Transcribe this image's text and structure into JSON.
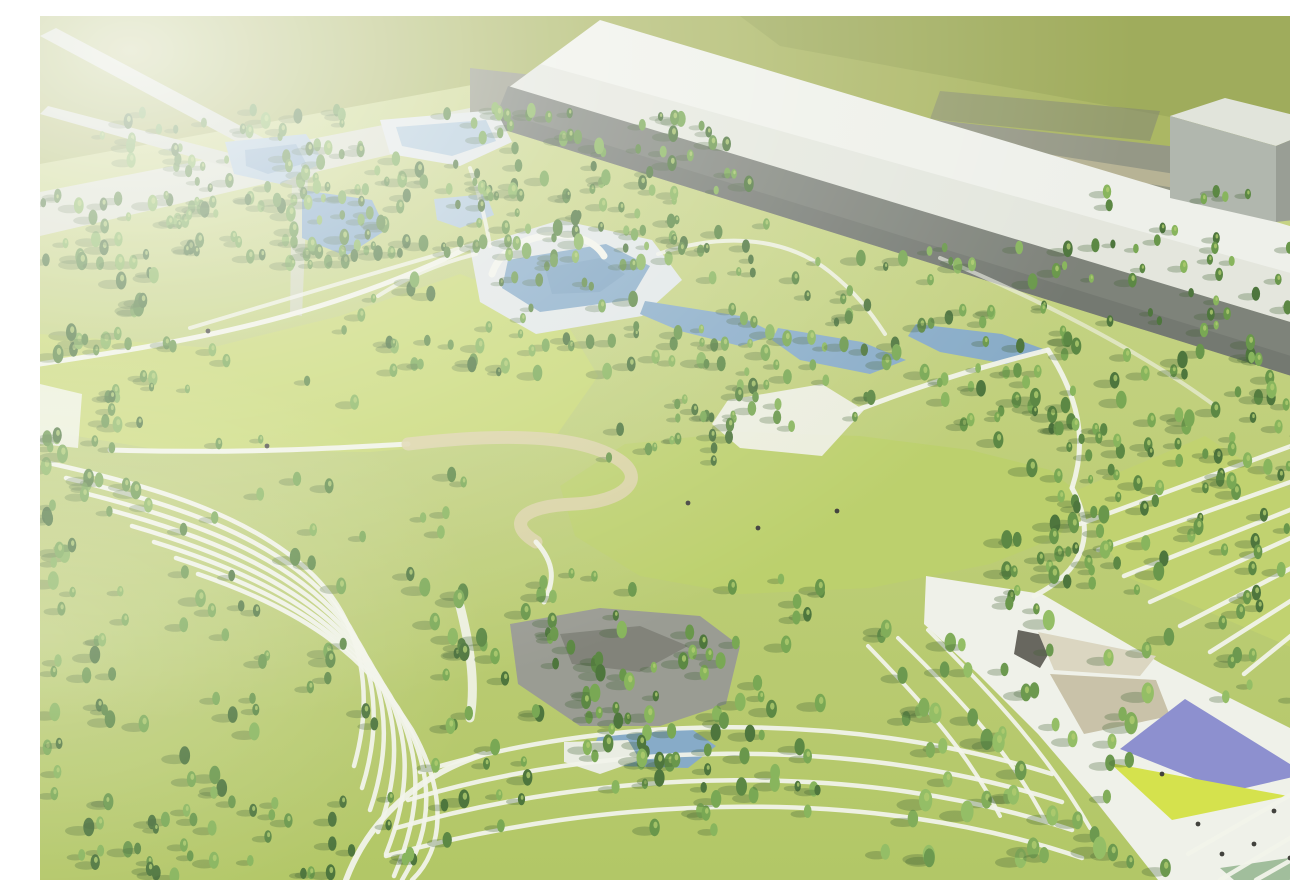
{
  "meta": {
    "description": "Hazy aerial architectural rendering of a large landscaped park: dense conifer forest, central great lawn, aquatic pool terraces with white arch, ponds, a rocky water garden, sweeping terraced lawn paths, an angular event plaza with purple and chartreuse canopies, and long gray industrial buildings along the top edge"
  },
  "colors": {
    "base_top": "#c8d484",
    "base_bottom": "#abc258",
    "field": "#a3b055",
    "field_dark": "#909f48",
    "road": "#8b8e7b",
    "road_dark": "#74776a",
    "tanline": "#cfc49a",
    "roof": "#eef0ea",
    "roof_shade": "#d2d6cc",
    "wall": "#71766e",
    "wall_dark": "#5f645d",
    "bldg_top": "#dfe2da",
    "bldg_left": "#aab0a7",
    "bldg_front": "#8f958c",
    "boundary": "#d7dcc9",
    "ramp": "#cfd5c3",
    "meadow": "#c3d567",
    "lawn": "#b6cc5f",
    "slope_lawn": "#bccf63",
    "path": "#f1f3ea",
    "tan": "#d9cfa2",
    "deck": "#dfe5e6",
    "water": "#7ba3c4",
    "water_light": "#a9c4d8",
    "water_deep": "#6792b6",
    "rock": "#90928a",
    "rock_dark": "#6e7067",
    "sand": "#e9ece3",
    "plaza": "#eff1e9",
    "canopy_dark": "#595750",
    "canopy_light": "#d8d3bd",
    "canopy_tan": "#c4bda2",
    "purple": "#8285cc",
    "chartreuse": "#d2e03c",
    "teal_lawn": "#98b893",
    "dot": "#2e2e2a",
    "tree_shadow": "#2f5220",
    "tree_fleck": "#a9c862",
    "haze": "#f2f5e8",
    "tree_palette": [
      "#3c682a",
      "#4b7c31",
      "#5a8d39",
      "#6ba043",
      "#7cae4d"
    ],
    "tree_light": [
      "#5d8f3e",
      "#74a54a",
      "#8ab857"
    ]
  },
  "scene": {
    "width": 1290,
    "height": 864,
    "polygons": [
      {
        "name": "far-field",
        "points": "0,0 1290,0 1290,170 470,62 0,148",
        "fill": "field"
      },
      {
        "name": "far-field-dark",
        "points": "700,0 1290,0 1290,130 740,30",
        "fill": "field_dark",
        "opacity": 0.7
      },
      {
        "name": "perimeter-road",
        "points": "430,52 1290,148 1290,208 430,102",
        "fill": "road"
      },
      {
        "name": "road-patch",
        "points": "900,75 1120,95 1110,125 890,103",
        "fill": "road_dark",
        "opacity": 0.5
      },
      {
        "name": "road-verge-strip",
        "points": "620,78 1290,182 1290,196 620,92",
        "fill": "tanline",
        "opacity": 0.55
      },
      {
        "name": "warehouse-roof",
        "points": "560,4 1290,222 1290,318 468,72",
        "fill": "roof"
      },
      {
        "name": "warehouse-roof-shade",
        "points": "500,48 1290,268 1290,318 468,72",
        "fill": "roof_shade",
        "opacity": 0.45
      },
      {
        "name": "warehouse-wall",
        "points": "468,70 1290,318 1290,372 452,110",
        "fill": "wall"
      },
      {
        "name": "warehouse-wall-base",
        "points": "460,96 1290,352 1290,372 452,110",
        "fill": "wall_dark",
        "opacity": 0.6
      },
      {
        "name": "annex-building-top",
        "points": "1130,100 1185,82 1290,108 1236,130",
        "fill": "bldg_top"
      },
      {
        "name": "annex-building-left",
        "points": "1130,100 1236,130 1236,206 1130,182",
        "fill": "bldg_left"
      },
      {
        "name": "annex-building-front",
        "points": "1236,130 1290,108 1290,200 1236,206",
        "fill": "bldg_front"
      },
      {
        "name": "boundary-wall",
        "points": "0,176 430,92 430,120 0,220",
        "fill": "boundary"
      },
      {
        "name": "overpass-ramp-a",
        "points": "0,20 16,12 280,152 268,164",
        "fill": "ramp"
      },
      {
        "name": "overpass-ramp-b",
        "points": "0,98 8,90 270,158 262,172",
        "fill": "ramp"
      },
      {
        "name": "overpass-pier",
        "points": "252,162 268,160 262,300 250,298",
        "fill": "ramp",
        "opacity": 0.8
      },
      {
        "name": "west-meadow",
        "points": "0,318 170,332 300,300 420,258 520,296 558,360 516,420 330,436 120,434 0,414",
        "fill": "meadow"
      },
      {
        "name": "west-entry-pad",
        "points": "0,368 42,378 38,432 0,428",
        "fill": "path",
        "opacity": 0.85
      },
      {
        "name": "great-lawn",
        "points": "520,470 585,428 700,416 820,420 930,434 1010,454 1040,478 1020,520 950,548 830,572 700,578 600,560 535,520",
        "fill": "lawn"
      },
      {
        "name": "east-slope-lawn",
        "points": "1035,475 1165,420 1290,500 1290,648 1085,560",
        "fill": "slope_lawn"
      },
      {
        "name": "pool-deck",
        "points": "430,232 520,204 612,224 642,264 602,300 496,318 440,286",
        "fill": "deck"
      },
      {
        "name": "main-pool",
        "points": "468,244 566,228 610,250 590,284 500,296 462,272",
        "fill": "water"
      },
      {
        "name": "main-pool-deep",
        "points": "505,252 560,242 585,258 560,276 512,278",
        "fill": "water_deep",
        "opacity": 0.6
      },
      {
        "name": "cascade-pool-1",
        "points": "605,285 700,300 736,318 700,330 640,315 600,298",
        "fill": "water"
      },
      {
        "name": "cascade-pool-2",
        "points": "738,312 822,326 866,344 830,358 760,344 732,324",
        "fill": "water"
      },
      {
        "name": "cascade-pool-3",
        "points": "876,308 962,318 1006,334 966,348 900,336 868,320",
        "fill": "water"
      },
      {
        "name": "central-court",
        "points": "688,384 782,368 824,394 782,440 700,432 672,408",
        "fill": "plaza",
        "opacity": 0.9
      },
      {
        "name": "north-pond-deck",
        "points": "185,126 266,118 284,146 240,168 194,158",
        "fill": "water_light"
      },
      {
        "name": "north-pond",
        "points": "205,134 256,128 266,147 228,158 206,150",
        "fill": "water",
        "opacity": 0.8
      },
      {
        "name": "terrace-pond-rim",
        "points": "340,104 456,94 472,126 420,150 350,138",
        "fill": "deck"
      },
      {
        "name": "terrace-pond",
        "points": "356,111 446,104 456,125 412,140 362,130",
        "fill": "water_light"
      },
      {
        "name": "forest-pond",
        "points": "262,174 332,184 346,214 306,240 262,222",
        "fill": "water"
      },
      {
        "name": "small-pond",
        "points": "394,183 446,178 454,199 420,212 397,204",
        "fill": "water_light"
      },
      {
        "name": "rock-garden",
        "points": "470,608 560,592 660,600 700,630 686,688 620,710 540,710 478,668",
        "fill": "rock"
      },
      {
        "name": "rock-garden-dark",
        "points": "520,618 600,610 648,630 600,656 532,648",
        "fill": "rock_dark",
        "opacity": 0.8
      },
      {
        "name": "rock-pond",
        "points": "560,716 650,712 676,730 648,752 580,750 552,734",
        "fill": "water"
      },
      {
        "name": "rock-sand",
        "points": "524,726 588,724 600,744 560,758 524,746",
        "fill": "sand"
      },
      {
        "name": "event-plaza",
        "points": "886,560 1002,578 1122,648 1290,732 1290,864 1118,864 1058,788 998,718 938,658 884,608",
        "fill": "plaza"
      },
      {
        "name": "plaza-canopy-dark",
        "points": "978,614 1018,622 1000,652 974,638",
        "fill": "canopy_dark"
      },
      {
        "name": "plaza-canopy-light",
        "points": "998,616 1116,640 1100,660 1014,654",
        "fill": "canopy_light"
      },
      {
        "name": "plaza-canopy-tan",
        "points": "1010,658 1116,664 1130,700 1044,718",
        "fill": "canopy_tan"
      },
      {
        "name": "plaza-purple-canopy",
        "points": "1080,733 1145,683 1266,758 1188,776",
        "fill": "purple"
      },
      {
        "name": "plaza-chartreuse-lawn",
        "points": "1070,747 1248,780 1132,804",
        "fill": "chartreuse"
      },
      {
        "name": "plaza-teal-panel",
        "points": "1180,852 1290,836 1290,864 1194,864",
        "fill": "teal_lawn"
      }
    ],
    "paths": [
      {
        "name": "meadow-top-path",
        "d": "M0,348 C130,328 280,306 440,226",
        "w": 5
      },
      {
        "name": "forest-diagonal-path",
        "d": "M150,312 C250,282 350,252 442,226",
        "w": 4,
        "opacity": 0.8
      },
      {
        "name": "meadow-bottom-path",
        "d": "M70,434 C200,438 300,432 368,428",
        "w": 5
      },
      {
        "name": "loop-promenade",
        "d": "M368,428 C470,416 540,420 576,442 C610,462 584,486 534,488 C480,490 466,508 496,526",
        "stroke": "tan",
        "w": 13,
        "opacity": 0.9
      },
      {
        "name": "loop-exit-path",
        "d": "M496,526 C516,548 514,566 504,586",
        "w": 5
      },
      {
        "name": "pool-east-path",
        "d": "M618,238 C690,214 750,224 790,256 C815,276 830,295 845,318",
        "w": 4,
        "opacity": 0.85
      },
      {
        "name": "plaza-ne-path",
        "d": "M812,396 C900,362 960,346 1008,334",
        "w": 5
      },
      {
        "name": "east-lawn-path",
        "d": "M1008,334 C1038,380 1048,424 1032,472",
        "w": 5
      },
      {
        "name": "lawn-plaza-path",
        "d": "M1032,472 C1058,520 1042,556 994,580",
        "w": 5
      },
      {
        "name": "south-entry-path",
        "d": "M306,864 C330,800 382,758 444,738",
        "w": 6
      },
      {
        "name": "rock-west-path",
        "d": "M420,590 C430,630 436,668 430,702",
        "w": 9,
        "opacity": 0.9
      },
      {
        "name": "deck-west-path",
        "d": "M436,238 C396,248 366,262 338,280",
        "w": 4,
        "opacity": 0.8
      },
      {
        "name": "pond-link-path",
        "d": "M430,152 C440,180 446,206 450,230",
        "w": 4,
        "opacity": 0.8
      },
      {
        "name": "building-base-path",
        "d": "M900,242 C1000,284 1100,334 1178,392",
        "w": 4,
        "opacity": 0.6
      },
      {
        "name": "aquatic-arch",
        "d": "M452,258 C466,214 544,206 564,240",
        "w": 7,
        "opacity": 1
      },
      {
        "name": "terrace-stripe-e1",
        "d": "M1040,508 L1262,426",
        "w": 4.5
      },
      {
        "name": "terrace-stripe-e2",
        "d": "M1058,534 L1290,452",
        "w": 4.5
      },
      {
        "name": "terrace-stripe-e3",
        "d": "M1084,560 L1290,478",
        "w": 4.5
      },
      {
        "name": "terrace-stripe-e4",
        "d": "M1110,586 L1290,504",
        "w": 4.5
      },
      {
        "name": "terrace-stripe-e5",
        "d": "M1140,610 L1290,532",
        "w": 4.5
      },
      {
        "name": "terrace-stripe-e6",
        "d": "M1170,636 L1290,560",
        "w": 4.5
      },
      {
        "name": "terrace-stripe-e7",
        "d": "M1204,658 L1290,588",
        "w": 4.5
      },
      {
        "name": "corner-stripe-1",
        "d": "M1148,838 L1290,756",
        "w": 4.5
      },
      {
        "name": "corner-stripe-2",
        "d": "M1180,864 L1290,798",
        "w": 4.5
      },
      {
        "name": "corner-stripe-3",
        "d": "M1216,864 L1290,822",
        "w": 4.5
      },
      {
        "name": "corner-stripe-4",
        "d": "M1252,864 L1290,846",
        "w": 4.5
      },
      {
        "name": "terrace-curve-w1",
        "d": "M4,446 C114,470 214,500 274,560 C324,610 334,680 314,750",
        "w": 4.5
      },
      {
        "name": "terrace-curve-w2",
        "d": "M26,462 C136,488 230,520 288,582 C336,634 344,702 322,772",
        "w": 4.5
      },
      {
        "name": "terrace-curve-w3",
        "d": "M48,478 C158,506 246,540 302,604 C348,658 354,724 330,794",
        "w": 4.5
      },
      {
        "name": "terrace-curve-w4",
        "d": "M70,494 C180,524 262,560 316,626 C360,682 364,746 338,816",
        "w": 4.5
      },
      {
        "name": "terrace-curve-w5",
        "d": "M92,510 C202,542 278,580 330,648 C372,706 374,768 346,838",
        "w": 4.5
      },
      {
        "name": "terrace-curve-w6",
        "d": "M114,526 C224,560 294,600 344,670 C384,730 384,790 354,860",
        "w": 4.5
      },
      {
        "name": "terrace-curve-w7",
        "d": "M136,542 C246,578 310,620 358,692 C396,754 394,812 362,864",
        "w": 4.5
      },
      {
        "name": "terrace-curve-w8",
        "d": "M158,558 C268,596 326,640 372,714 C408,778 404,834 372,864",
        "w": 4.5
      },
      {
        "name": "terrace-sweep-s1",
        "d": "M380,756 C560,700 800,692 1012,758",
        "w": 4.5
      },
      {
        "name": "terrace-sweep-s2",
        "d": "M368,784 C560,726 810,718 1022,786",
        "w": 4.5
      },
      {
        "name": "terrace-sweep-s3",
        "d": "M356,812 C566,752 822,744 1032,814",
        "w": 4.5
      },
      {
        "name": "terrace-sweep-s4",
        "d": "M346,840 C572,778 832,770 1042,842",
        "w": 4.5
      },
      {
        "name": "terrace-fan-f1",
        "d": "M828,630 C888,692 930,740 960,800",
        "w": 4
      },
      {
        "name": "terrace-fan-f2",
        "d": "M858,622 C926,688 972,740 1006,806",
        "w": 4
      },
      {
        "name": "terrace-fan-f3",
        "d": "M888,614 C958,684 1010,742 1050,812",
        "w": 4
      }
    ],
    "tree_clusters": [
      {
        "name": "grove-boundary-west",
        "x": 0,
        "y": 150,
        "w": 300,
        "h": 100,
        "n": 40,
        "rmin": 4,
        "rmax": 8,
        "seed": 16
      },
      {
        "name": "grove-north-belt",
        "x": 60,
        "y": 92,
        "w": 630,
        "h": 150,
        "n": 150,
        "rmin": 4,
        "rmax": 8,
        "seed": 1
      },
      {
        "name": "grove-mid-belt",
        "x": 300,
        "y": 148,
        "w": 430,
        "h": 210,
        "n": 115,
        "rmin": 4,
        "rmax": 8,
        "seed": 3
      },
      {
        "name": "grove-along-building",
        "x": 1050,
        "y": 175,
        "w": 240,
        "h": 140,
        "n": 40,
        "rmin": 4,
        "rmax": 7,
        "seed": 6
      },
      {
        "name": "grove-west-edge",
        "x": 0,
        "y": 240,
        "w": 120,
        "h": 270,
        "n": 45,
        "rmin": 5,
        "rmax": 9,
        "seed": 2
      },
      {
        "name": "grove-center-right",
        "x": 690,
        "y": 228,
        "w": 340,
        "h": 185,
        "n": 85,
        "rmin": 4,
        "rmax": 8,
        "seed": 4
      },
      {
        "name": "grove-east-forest",
        "x": 950,
        "y": 325,
        "w": 340,
        "h": 270,
        "n": 115,
        "rmin": 5,
        "rmax": 9,
        "seed": 5
      },
      {
        "name": "tree-row-east-path",
        "x": 1018,
        "y": 398,
        "w": 70,
        "h": 185,
        "n": 14,
        "rmin": 4,
        "rmax": 7,
        "seed": 11
      },
      {
        "name": "meadow-scatter-trees",
        "x": 60,
        "y": 325,
        "w": 390,
        "h": 115,
        "n": 16,
        "rmin": 4,
        "rmax": 8,
        "seed": 12
      },
      {
        "name": "lawn-arm-trees",
        "x": 560,
        "y": 380,
        "w": 140,
        "h": 70,
        "n": 20,
        "rmin": 4,
        "rmax": 7,
        "seed": 17
      },
      {
        "name": "grove-terrace-scatter",
        "x": 140,
        "y": 450,
        "w": 290,
        "h": 270,
        "n": 40,
        "rmin": 5,
        "rmax": 9,
        "seed": 8
      },
      {
        "name": "grove-far-left-mid",
        "x": 0,
        "y": 520,
        "w": 90,
        "h": 180,
        "n": 18,
        "rmin": 5,
        "rmax": 9,
        "seed": 15
      },
      {
        "name": "grove-south-forest",
        "x": 380,
        "y": 555,
        "w": 410,
        "h": 260,
        "n": 115,
        "rmin": 5,
        "rmax": 9,
        "seed": 7
      },
      {
        "name": "grove-plaza-trees",
        "x": 830,
        "y": 600,
        "w": 300,
        "h": 264,
        "n": 55,
        "rmin": 6,
        "rmax": 11,
        "palette": "light",
        "seed": 10
      },
      {
        "name": "grove-se-edge",
        "x": 1150,
        "y": 588,
        "w": 140,
        "h": 120,
        "n": 10,
        "rmin": 5,
        "rmax": 8,
        "palette": "light",
        "seed": 14
      },
      {
        "name": "grove-sw-corner",
        "x": 0,
        "y": 695,
        "w": 210,
        "h": 169,
        "n": 35,
        "rmin": 5,
        "rmax": 9,
        "seed": 9
      },
      {
        "name": "grove-south-band",
        "x": 190,
        "y": 778,
        "w": 280,
        "h": 86,
        "n": 22,
        "rmin": 5,
        "rmax": 8,
        "seed": 13
      }
    ],
    "people": [
      [
        168,
        315
      ],
      [
        227,
        430
      ],
      [
        648,
        487
      ],
      [
        718,
        512
      ],
      [
        797,
        495
      ],
      [
        1122,
        758
      ],
      [
        1158,
        808
      ],
      [
        1182,
        838
      ],
      [
        1214,
        828
      ],
      [
        1234,
        795
      ],
      [
        1280,
        764
      ],
      [
        1250,
        842
      ]
    ]
  }
}
